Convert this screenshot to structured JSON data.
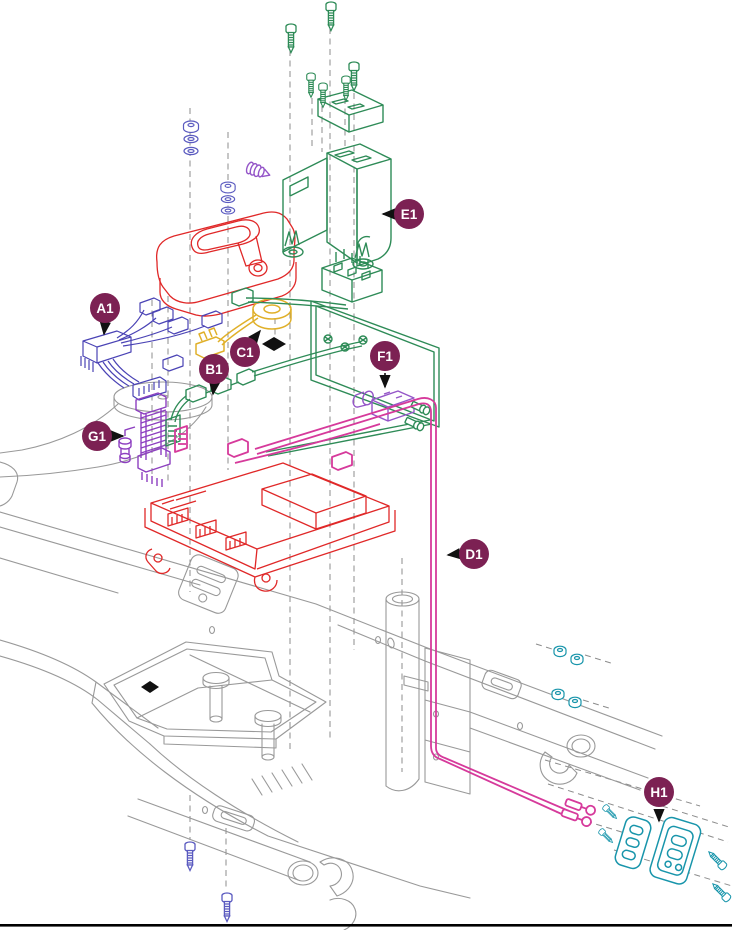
{
  "note": {
    "lines": [
      "When applicable, assemblies are grouped",
      "by color. All components with that color",
      "are included in the assembly."
    ]
  },
  "callouts": [
    {
      "label": "A1",
      "assembly_color": "#4a43b5"
    },
    {
      "label": "B1",
      "assembly_color": "#2e8b57"
    },
    {
      "label": "C1",
      "assembly_color": "#e0b02a"
    },
    {
      "label": "D1",
      "assembly_color": "#d63a9b"
    },
    {
      "label": "E1",
      "assembly_color": "#2e8b57"
    },
    {
      "label": "F1",
      "assembly_color": "#9455c8"
    },
    {
      "label": "G1",
      "assembly_color": "#8d3fc0"
    },
    {
      "label": "H1",
      "assembly_color": "#1895ab"
    }
  ],
  "palette": {
    "badge_fill": "#7c2153",
    "badge_text": "#ffffff",
    "frame_line": "#999999",
    "red_assembly": "#e02828",
    "blue_fasteners": "#5b5bc0",
    "background": "#ffffff",
    "footer_rule": "#000000"
  }
}
